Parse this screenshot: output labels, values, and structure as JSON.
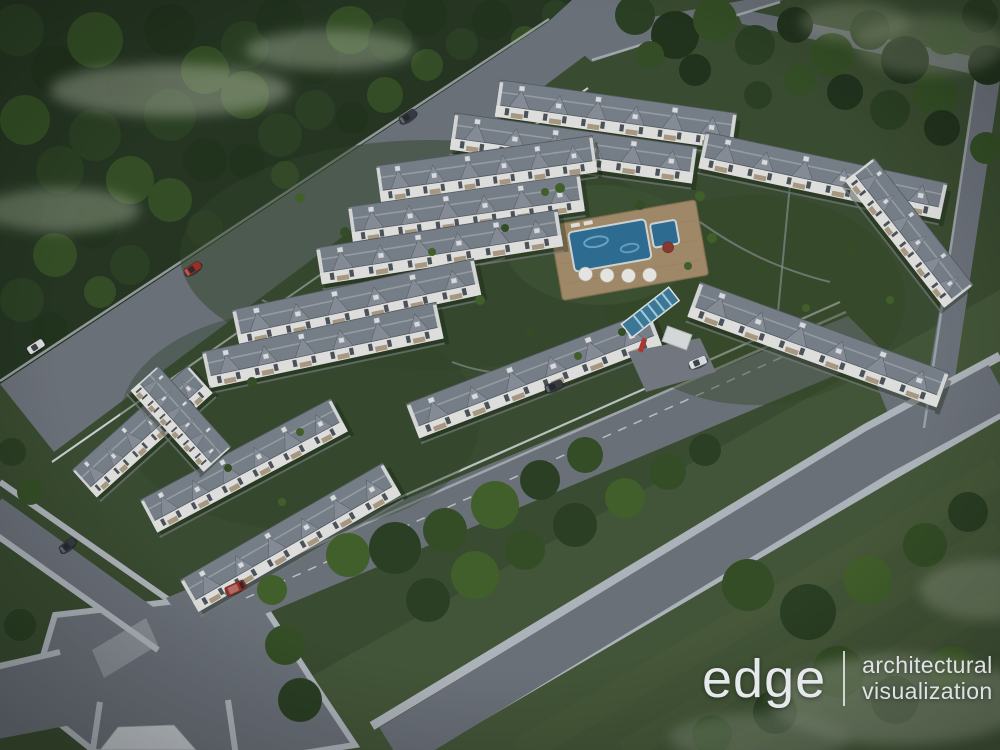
{
  "logo": {
    "brand": "edge",
    "tagline_line1": "architectural",
    "tagline_line2": "visualization"
  },
  "scene": {
    "view": "aerial dusk 3D render of a gated townhouse community",
    "surroundings": [
      "dense forest belt along the north-west road",
      "tree-dotted lawns to the south-east",
      "perimeter roads with light sidewalks and a five-way intersection"
    ],
    "amenities": [
      "central swimming pool with kids pool, timber deck and white parasols",
      "gated entrance with glazed blue canopy"
    ],
    "buildings": {
      "type": "two-storey white townhouse rows with grey hipped roofs, gables and balconies",
      "row_count": 15
    },
    "vehicles": {
      "count": 7,
      "colors": [
        "dark-grey",
        "red",
        "white"
      ]
    }
  },
  "theme": {
    "forest_dark": "#263622",
    "t1": "#22331d",
    "t2": "#2c4124",
    "t3": "#365026",
    "t4": "#44622b",
    "lawn": "#3b4d31",
    "lawn_se": "#465839",
    "mist": "#b7c2ab",
    "mist_se": "#9fac93",
    "road": "#6f747d",
    "sidewalk": "#b5bac1",
    "curb": "#d3d6da",
    "roof": "#7b828c",
    "roof_dark": "#565c64",
    "ridge": "#9ba2aa",
    "gable": "#8b919b",
    "wall": "#e8e8e6",
    "window": "#4e545b",
    "balcony": "#b09d85",
    "deck": "#a78e6b",
    "pool": "#2f6f97",
    "pool_light": "#7fb8d6",
    "accent_red": "#b23a30",
    "car_red": "#9b3129",
    "car_dark": "#383d44",
    "car_white": "#e2e4e6",
    "logo": "#e6e9eb"
  }
}
